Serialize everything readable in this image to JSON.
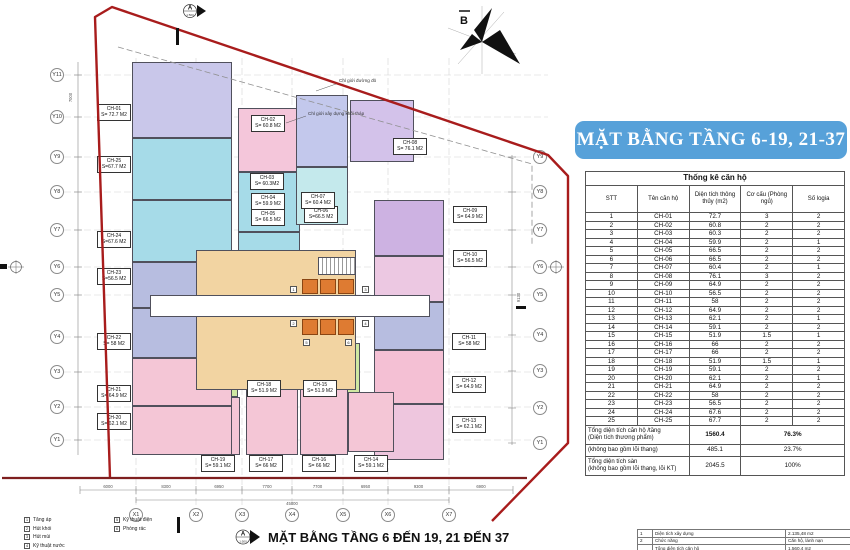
{
  "banner": {
    "title": "MẶT BẰNG TẦNG 6-19, 21-37",
    "bg_color": "#57a1d9"
  },
  "caption": "MẶT BẰNG TẦNG 6 ĐẾN 19, 21 ĐẾN 37",
  "north_label": "B",
  "markers": {
    "top": "A",
    "bottom": "A",
    "scale": "1:500"
  },
  "boundary_labels": {
    "red_line": "Chỉ giới đường đỏ",
    "construction": "Chỉ giới xây dựng khối tháp"
  },
  "colors": {
    "red_boundary": "#a81c1c",
    "lift_orange": "#de7b32",
    "core_tan": "#f2d4a2",
    "banner_blue": "#57a1d9"
  },
  "grid": {
    "left": [
      "Y11",
      "Y10",
      "Y9",
      "Y8",
      "Y7",
      "Y6",
      "Y5",
      "Y4",
      "Y3",
      "Y2",
      "Y1"
    ],
    "right": [
      "Y9",
      "Y8",
      "Y7",
      "Y6",
      "Y5",
      "Y4",
      "Y3",
      "Y2",
      "Y1"
    ],
    "bottom": [
      "X1",
      "X2",
      "X3",
      "X4",
      "X5",
      "X6",
      "X7"
    ]
  },
  "dimensions": {
    "bottom": [
      "6000",
      "8300",
      "6950",
      "7700",
      "7700",
      "6950",
      "9300",
      "6900"
    ],
    "bottom_total": "45000",
    "left_top": "7000",
    "right_side": "9130"
  },
  "plan": {
    "apartments": [
      {
        "id": "CH-01",
        "area": "S= 72.7 M2",
        "color": "#c9c7ea"
      },
      {
        "id": "CH-02",
        "area": "S= 60.8 M2",
        "color": "#f4c6da"
      },
      {
        "id": "CH-03",
        "area": "S= 60.3M2",
        "color": "#a6dbe8"
      },
      {
        "id": "CH-04",
        "area": "S= 59.9 M2",
        "color": "#a6dbe8"
      },
      {
        "id": "CH-05",
        "area": "S= 66.5 M2",
        "color": "#c4e9ec"
      },
      {
        "id": "CH-06",
        "area": "S=66.5 M2",
        "color": "#c4e9ec"
      },
      {
        "id": "CH-07",
        "area": "S= 60.4 M2",
        "color": "#c3c8ec"
      },
      {
        "id": "CH-08",
        "area": "S= 76.1 M2",
        "color": "#d3c2ea"
      },
      {
        "id": "CH-09",
        "area": "S= 64.9 M2",
        "color": "#cdb2e2"
      },
      {
        "id": "CH-10",
        "area": "S= 56.5 M2",
        "color": "#ecc8e2"
      },
      {
        "id": "CH-11",
        "area": "S= 58 M2",
        "color": "#b7bde0"
      },
      {
        "id": "CH-12",
        "area": "S= 64.9 M2",
        "color": "#f4c0d4"
      },
      {
        "id": "CH-13",
        "area": "S= 62.1 M2",
        "color": "#eec6de"
      },
      {
        "id": "CH-14",
        "area": "S= 59.1 M2",
        "color": "#f4c6d6"
      },
      {
        "id": "CH-15",
        "area": "S= 51.9 M2",
        "color": "#cfe8a2"
      },
      {
        "id": "CH-16",
        "area": "S= 66 M2",
        "color": "#f4c6d6"
      },
      {
        "id": "CH-17",
        "area": "S= 66 M2",
        "color": "#f4c6d6"
      },
      {
        "id": "CH-18",
        "area": "S= 51.9 M2",
        "color": "#cfe8a2"
      },
      {
        "id": "CH-19",
        "area": "S= 59.1 M2",
        "color": "#f4c6d6"
      },
      {
        "id": "CH-20",
        "area": "S= 62.1 M2",
        "color": "#f4c6d6"
      },
      {
        "id": "CH-21",
        "area": "S= 64.9 M2",
        "color": "#f4c6d6"
      },
      {
        "id": "CH-22",
        "area": "S= 58 M2",
        "color": "#b7bde0"
      },
      {
        "id": "CH-23",
        "area": "S=56.5 M2",
        "color": "#b7bde0"
      },
      {
        "id": "CH-24",
        "area": "S=67.6 M2",
        "color": "#a6dbe8"
      },
      {
        "id": "CH-25",
        "area": "S=67.7 M2",
        "color": "#a6dbe8"
      }
    ]
  },
  "stats_table": {
    "title": "Thống kê căn hộ",
    "columns": [
      "STT",
      "Tên căn hộ",
      "Diện tích thông thủy (m2)",
      "Cơ cấu (Phòng ngủ)",
      "Số logia"
    ],
    "rows": [
      [
        "1",
        "CH-01",
        "72.7",
        "3",
        "2"
      ],
      [
        "2",
        "CH-02",
        "60.8",
        "2",
        "2"
      ],
      [
        "3",
        "CH-03",
        "60.3",
        "2",
        "2"
      ],
      [
        "4",
        "CH-04",
        "59.9",
        "2",
        "1"
      ],
      [
        "5",
        "CH-05",
        "66.5",
        "2",
        "2"
      ],
      [
        "6",
        "CH-06",
        "66.5",
        "2",
        "2"
      ],
      [
        "7",
        "CH-07",
        "60.4",
        "2",
        "1"
      ],
      [
        "8",
        "CH-08",
        "76.1",
        "3",
        "2"
      ],
      [
        "9",
        "CH-09",
        "64.9",
        "2",
        "2"
      ],
      [
        "10",
        "CH-10",
        "56.5",
        "2",
        "2"
      ],
      [
        "11",
        "CH-11",
        "58",
        "2",
        "2"
      ],
      [
        "12",
        "CH-12",
        "64.9",
        "2",
        "2"
      ],
      [
        "13",
        "CH-13",
        "62.1",
        "2",
        "1"
      ],
      [
        "14",
        "CH-14",
        "59.1",
        "2",
        "2"
      ],
      [
        "15",
        "CH-15",
        "51.9",
        "1.5",
        "1"
      ],
      [
        "16",
        "CH-16",
        "66",
        "2",
        "2"
      ],
      [
        "17",
        "CH-17",
        "66",
        "2",
        "2"
      ],
      [
        "18",
        "CH-18",
        "51.9",
        "1.5",
        "1"
      ],
      [
        "19",
        "CH-19",
        "59.1",
        "2",
        "2"
      ],
      [
        "20",
        "CH-20",
        "62.1",
        "2",
        "1"
      ],
      [
        "21",
        "CH-21",
        "64.9",
        "2",
        "2"
      ],
      [
        "22",
        "CH-22",
        "58",
        "2",
        "2"
      ],
      [
        "23",
        "CH-23",
        "56.5",
        "2",
        "2"
      ],
      [
        "24",
        "CH-24",
        "67.6",
        "2",
        "2"
      ],
      [
        "25",
        "CH-25",
        "67.7",
        "2",
        "2"
      ]
    ],
    "footers": [
      {
        "label": "Tổng diện tích căn hộ /tầng\n(Diện tích thương phẩm)",
        "value": "1560.4",
        "pct": "76.3%",
        "bold": true
      },
      {
        "label": "(không bao gồm lõi thang)",
        "value": "485.1",
        "pct": "23.7%",
        "bold": false
      },
      {
        "label": "Tổng diện tích sàn\n(không bao gồm lõi thang, lõi KT)",
        "value": "2045.5",
        "pct": "100%",
        "bold": false
      }
    ]
  },
  "legend": {
    "items": [
      {
        "num": "1",
        "label": "Tăng áp"
      },
      {
        "num": "2",
        "label": "Hút khói"
      },
      {
        "num": "3",
        "label": "Hút mùi"
      },
      {
        "num": "4",
        "label": "Kỹ thuật nước"
      },
      {
        "num": "5",
        "label": "Kỹ thuật điện"
      },
      {
        "num": "6",
        "label": "Phòng rác"
      }
    ]
  },
  "info_table": {
    "rows": [
      [
        "1",
        "Diện tích xây dựng",
        "2.135,48 m2"
      ],
      [
        "2",
        "Chức năng",
        "Căn hộ, lánh nạn"
      ],
      [
        "",
        "Tổng diện tích căn hộ",
        "1.560,4 m2"
      ]
    ]
  }
}
